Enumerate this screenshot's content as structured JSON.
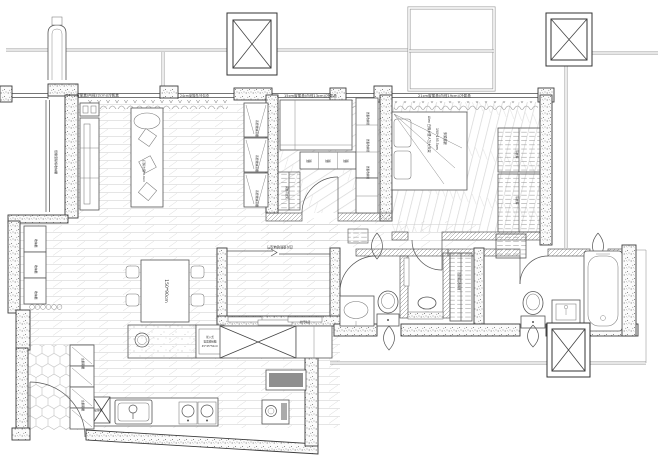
{
  "labels": {
    "curtain_left": "24cm窗簾盒(內徑22cm)/冷氣盒",
    "curtain_left2": "24cm窗簾盒/冷氣盒",
    "curtain_mid": "15cm窗簾盒(內徑13cm)/冷氣盒",
    "curtain_right": "21cm窗簾盒(內徑19cm)/冷氣盒",
    "bench": "低檯度臥榻收納櫃",
    "sofa": "訂製沙發310cm",
    "tv_cab": "系統收納高櫃",
    "side_cab": "收納櫃",
    "table": "150*90cm",
    "island1": "崁入式",
    "island2": "電器收納櫃",
    "island3": "45*45*50cm",
    "roller": "捲門電器櫃",
    "shoe": "玄關鞋櫃",
    "drawer": "抽屜",
    "bed2_cab": "層板收納櫃",
    "closet2": "開放吊衣架",
    "bed_name": "Alex 白橡木雙人加大床架",
    "bed_size": "190*195.5cm",
    "bed_note": "床頭靠牆",
    "hang": "吊衣桿",
    "linen": "浴室備品收納櫃",
    "tatami_door": "四片連動玻璃拉門",
    "track": "拉門軌道"
  },
  "colors": {
    "wall_stroke": "#3c3c3c",
    "line": "#555555",
    "edge_gray": "#9c9c9c",
    "floor_line": "#cbcbcb"
  }
}
